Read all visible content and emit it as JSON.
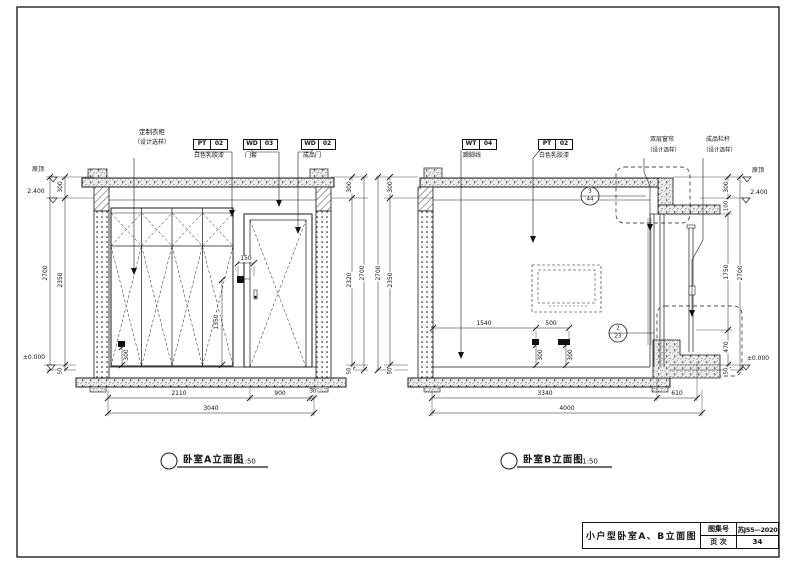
{
  "title_block": {
    "drawing_title": "小户型卧室A、B立面图",
    "atlas_label": "图集号",
    "atlas_number": "苏J55—2020",
    "page_label": "页 次",
    "page_number": "34"
  },
  "elevation_a": {
    "caption": "卧室A立面图",
    "scale": "1:50",
    "wardrobe_label": {
      "line1": "定制衣柜",
      "line2": "（设计选样）"
    },
    "tags": [
      {
        "code": "PT",
        "num": "02",
        "desc": "白色乳胶漆"
      },
      {
        "code": "WD",
        "num": "03",
        "desc": "门套"
      },
      {
        "code": "WD",
        "num": "02",
        "desc": "成品门"
      }
    ],
    "levels": {
      "original_ceiling": "原顶",
      "ceiling": "2.400",
      "floor": "±0.000"
    },
    "dims": {
      "left": {
        "top": "300",
        "middle": "2350",
        "bottom": "50",
        "overall": "2700"
      },
      "right": {
        "top": "300",
        "middle": "2320",
        "bottom": "50",
        "overall": "2700"
      },
      "bottom": {
        "wardrobe": "2110",
        "door": "900",
        "edge": "30",
        "overall": "3040"
      },
      "switch_offset": "150",
      "switch_height": "1350",
      "socket_height": "300"
    }
  },
  "elevation_b": {
    "caption": "卧室B立面图",
    "scale": "1:50",
    "tags": [
      {
        "code": "WT",
        "num": "04",
        "desc": "踢脚线"
      },
      {
        "code": "PT",
        "num": "02",
        "desc": "白色乳胶漆"
      }
    ],
    "curtain_label": {
      "line1": "双层窗帘",
      "line2": "（设计选样）"
    },
    "railing_label": {
      "line1": "成品栏杆",
      "line2": "（设计选样）"
    },
    "levels": {
      "original_ceiling": "原顶",
      "ceiling": "2.400",
      "floor": "±0.000"
    },
    "details": {
      "ceiling_ref": {
        "num": "3",
        "sheet": "44"
      },
      "floor_ref": {
        "num": "2",
        "sheet": "23"
      }
    },
    "dims": {
      "left": {
        "top": "300",
        "middle": "2350",
        "bottom": "50",
        "overall": "2700"
      },
      "right": {
        "top": "300",
        "upper": "100",
        "window": "1750",
        "sill": "470",
        "bottom": "50",
        "overall": "2700"
      },
      "bottom": {
        "room": "3340",
        "balcony": "610",
        "overall": "4000"
      },
      "tv_offset": "1540",
      "socket_spacing": "500",
      "socket_height_left": "300",
      "socket_height_right": "300"
    }
  }
}
